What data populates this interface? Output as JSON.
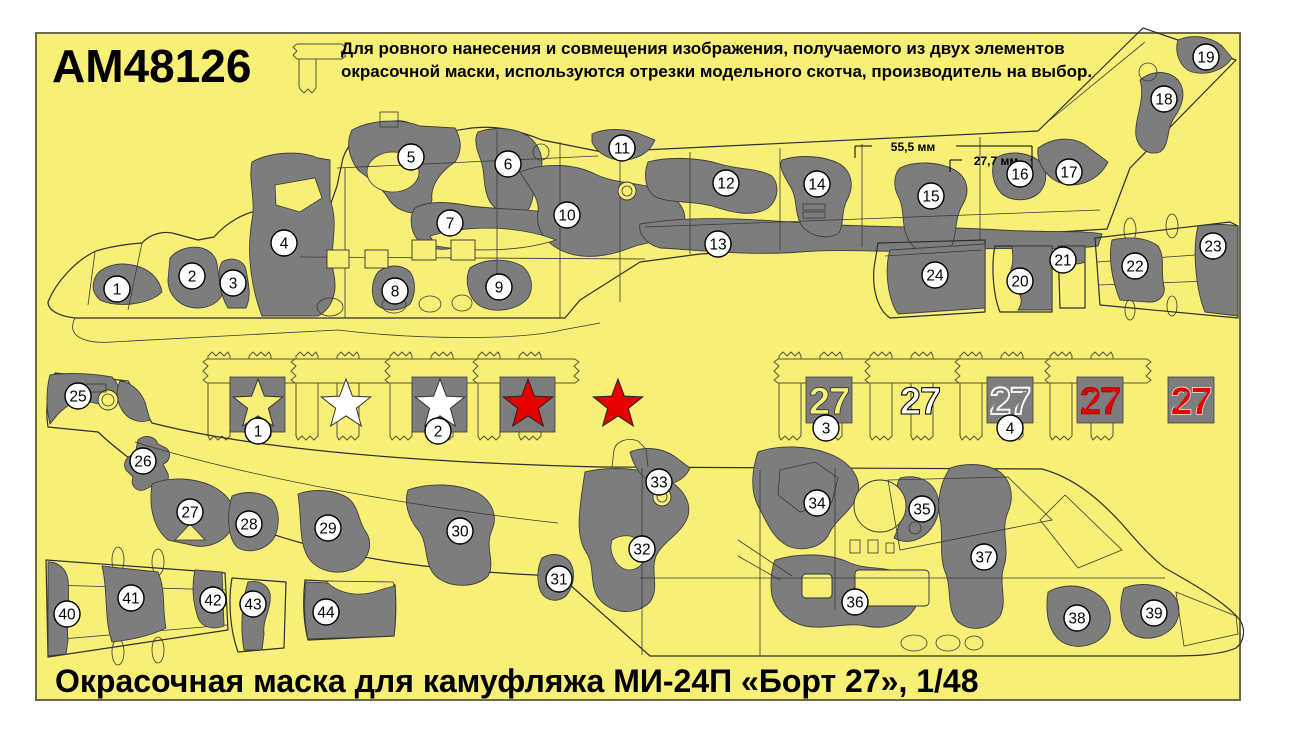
{
  "title": {
    "product_code": "AM48126"
  },
  "instructions": {
    "line1": "Для ровного нанесения и совмещения изображения, получаемого из двух элементов",
    "line2": "окрасочной маски, используются отрезки модельного скотча, производитель на выбор."
  },
  "caption": {
    "text": "Окрасочная маска для камуфляжа МИ-24П «Борт 27», 1/48"
  },
  "dimensions": {
    "d1": "55,5 мм",
    "d2": "27,7 мм"
  },
  "insignia": {
    "number_text": "27"
  },
  "colors": {
    "sheet_yellow": "#f7ef76",
    "camo_gray": "#7d7d7d",
    "red": "#e60000",
    "white": "#ffffff",
    "outline": "#2e2e2e"
  },
  "markers": [
    {
      "label": "1",
      "x": 117,
      "y": 289
    },
    {
      "label": "2",
      "x": 192,
      "y": 276
    },
    {
      "label": "3",
      "x": 233,
      "y": 283
    },
    {
      "label": "4",
      "x": 284,
      "y": 243
    },
    {
      "label": "5",
      "x": 411,
      "y": 157
    },
    {
      "label": "6",
      "x": 508,
      "y": 164
    },
    {
      "label": "7",
      "x": 450,
      "y": 223
    },
    {
      "label": "8",
      "x": 395,
      "y": 291
    },
    {
      "label": "9",
      "x": 499,
      "y": 287
    },
    {
      "label": "10",
      "x": 567,
      "y": 215
    },
    {
      "label": "11",
      "x": 622,
      "y": 148
    },
    {
      "label": "12",
      "x": 726,
      "y": 183
    },
    {
      "label": "13",
      "x": 718,
      "y": 244
    },
    {
      "label": "14",
      "x": 817,
      "y": 184
    },
    {
      "label": "15",
      "x": 931,
      "y": 196
    },
    {
      "label": "16",
      "x": 1020,
      "y": 174
    },
    {
      "label": "17",
      "x": 1069,
      "y": 172
    },
    {
      "label": "18",
      "x": 1164,
      "y": 99
    },
    {
      "label": "19",
      "x": 1206,
      "y": 57
    },
    {
      "label": "20",
      "x": 1020,
      "y": 281
    },
    {
      "label": "21",
      "x": 1063,
      "y": 260
    },
    {
      "label": "22",
      "x": 1135,
      "y": 266
    },
    {
      "label": "23",
      "x": 1213,
      "y": 246
    },
    {
      "label": "24",
      "x": 935,
      "y": 275
    },
    {
      "label": "1",
      "x": 258,
      "y": 431
    },
    {
      "label": "2",
      "x": 438,
      "y": 431
    },
    {
      "label": "3",
      "x": 826,
      "y": 428
    },
    {
      "label": "4",
      "x": 1010,
      "y": 428
    },
    {
      "label": "25",
      "x": 78,
      "y": 396
    },
    {
      "label": "26",
      "x": 143,
      "y": 461
    },
    {
      "label": "27",
      "x": 190,
      "y": 512
    },
    {
      "label": "28",
      "x": 249,
      "y": 524
    },
    {
      "label": "29",
      "x": 328,
      "y": 528
    },
    {
      "label": "30",
      "x": 460,
      "y": 531
    },
    {
      "label": "31",
      "x": 559,
      "y": 579
    },
    {
      "label": "32",
      "x": 642,
      "y": 549
    },
    {
      "label": "33",
      "x": 659,
      "y": 482
    },
    {
      "label": "34",
      "x": 817,
      "y": 503
    },
    {
      "label": "35",
      "x": 922,
      "y": 509
    },
    {
      "label": "36",
      "x": 855,
      "y": 602
    },
    {
      "label": "37",
      "x": 984,
      "y": 557
    },
    {
      "label": "38",
      "x": 1077,
      "y": 618
    },
    {
      "label": "39",
      "x": 1154,
      "y": 613
    },
    {
      "label": "40",
      "x": 67,
      "y": 614
    },
    {
      "label": "41",
      "x": 131,
      "y": 598
    },
    {
      "label": "42",
      "x": 213,
      "y": 600
    },
    {
      "label": "43",
      "x": 253,
      "y": 604
    },
    {
      "label": "44",
      "x": 326,
      "y": 612
    }
  ]
}
